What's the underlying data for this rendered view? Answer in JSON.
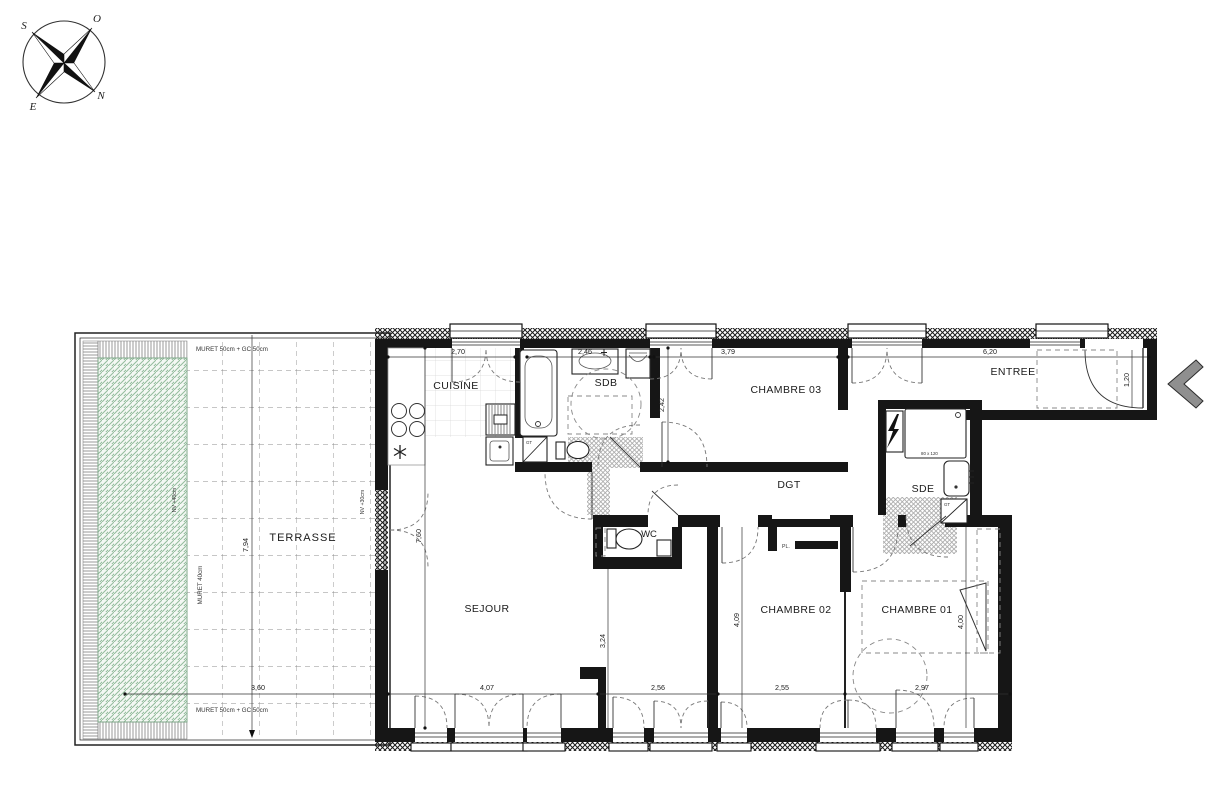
{
  "compass": {
    "north": "N",
    "south": "S",
    "east": "E",
    "west": "O"
  },
  "terrace": {
    "label": "TERRASSE",
    "wall_note_top": "MURET 50cm + GC 50cm",
    "wall_note_bottom": "MURET 50cm + GC 50cm",
    "wall_note_left": "MURET 40cm",
    "planter_level": "NV +40cm",
    "terrace_level": "NV +30cm",
    "dim_depth": "7,94",
    "dim_width": "3,60"
  },
  "rooms": {
    "cuisine": {
      "label": "CUISINE",
      "dim_width": "2,70"
    },
    "sdb": {
      "label": "SDB",
      "dim_width": "2,46"
    },
    "chambre03": {
      "label": "CHAMBRE 03",
      "dim_width": "3,79",
      "dim_depth": "2,42"
    },
    "entree": {
      "label": "ENTREE",
      "dim_width": "6,20",
      "dim_door": "1,20"
    },
    "sde": {
      "label": "SDE",
      "shower_size": "80 x 120"
    },
    "dgt": {
      "label": "DGT"
    },
    "wc": {
      "label": "WC"
    },
    "sejour": {
      "label": "SEJOUR",
      "dim_depth": "7,60",
      "dim_depth_right": "3,24",
      "dim_width_left": "4,07",
      "dim_width_right": "2,56"
    },
    "chambre02": {
      "label": "CHAMBRE 02",
      "dim_depth": "4,09",
      "dim_width": "2,55",
      "closet": "PL."
    },
    "chambre01": {
      "label": "CHAMBRE 01",
      "dim_depth": "4,00",
      "dim_width": "2,97"
    },
    "gt": {
      "label": "GT"
    }
  }
}
